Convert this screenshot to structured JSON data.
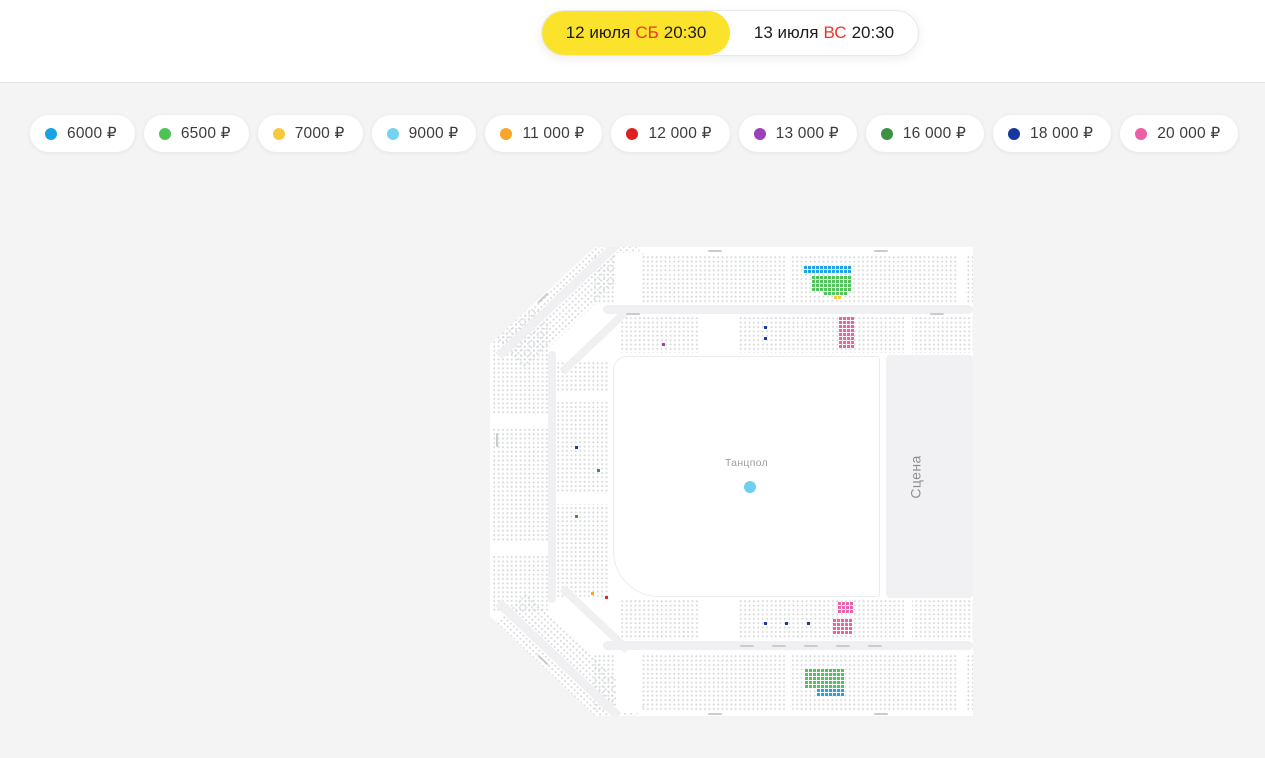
{
  "header": {
    "tabs": [
      {
        "date": "12 июля",
        "day": "СБ",
        "time": "20:30",
        "active": true
      },
      {
        "date": "13 июля",
        "day": "ВС",
        "time": "20:30",
        "active": false
      }
    ],
    "active_tab_color": "#fbe22b",
    "day_accent_color": "#ee342b"
  },
  "legend": {
    "items": [
      {
        "label": "6000 ₽",
        "color": "#1ba2e4"
      },
      {
        "label": "6500 ₽",
        "color": "#4ec257"
      },
      {
        "label": "7000 ₽",
        "color": "#f6ca3e"
      },
      {
        "label": "9000 ₽",
        "color": "#74d3f2"
      },
      {
        "label": "11 000 ₽",
        "color": "#f8a62a"
      },
      {
        "label": "12 000 ₽",
        "color": "#dd1f1f"
      },
      {
        "label": "13 000 ₽",
        "color": "#9c3fba"
      },
      {
        "label": "16 000 ₽",
        "color": "#3c9145"
      },
      {
        "label": "18 000 ₽",
        "color": "#16379c"
      },
      {
        "label": "20 000 ₽",
        "color": "#ea5fa6"
      }
    ]
  },
  "map": {
    "dancefloor_label": "Танцпол",
    "stage_label": "Сцена",
    "dancefloor_dot_color": "#6ed0f1",
    "seat_clusters": [
      {
        "color": "#1ba2e4",
        "x": 314,
        "y": 21,
        "rows": 2,
        "cols": 12
      },
      {
        "color": "#4ec257",
        "x": 322,
        "y": 31,
        "rows": 4,
        "cols": 10
      },
      {
        "color": "#4ec257",
        "x": 334,
        "y": 47,
        "rows": 1,
        "cols": 6
      },
      {
        "color": "#f6ca3e",
        "x": 344,
        "y": 51,
        "rows": 1,
        "cols": 2
      },
      {
        "color": "#ea5fa6",
        "x": 349,
        "y": 72,
        "rows": 8,
        "cols": 4
      },
      {
        "color": "#16379c",
        "x": 274,
        "y": 81,
        "rows": 1,
        "cols": 1
      },
      {
        "color": "#16379c",
        "x": 274,
        "y": 92,
        "rows": 1,
        "cols": 1
      },
      {
        "color": "#9c3fba",
        "x": 172,
        "y": 98,
        "rows": 1,
        "cols": 1
      },
      {
        "color": "#16379c",
        "x": 85,
        "y": 201,
        "rows": 1,
        "cols": 1
      },
      {
        "color": "#3c9145",
        "x": 107,
        "y": 224,
        "rows": 1,
        "cols": 1
      },
      {
        "color": "#3c9145",
        "x": 85,
        "y": 270,
        "rows": 1,
        "cols": 1
      },
      {
        "color": "#f8a62a",
        "x": 101,
        "y": 347,
        "rows": 1,
        "cols": 1
      },
      {
        "color": "#dd1f1f",
        "x": 115,
        "y": 351,
        "rows": 1,
        "cols": 1
      },
      {
        "color": "#ea5fa6",
        "x": 348,
        "y": 357,
        "rows": 3,
        "cols": 4
      },
      {
        "color": "#ea5fa6",
        "x": 343,
        "y": 374,
        "rows": 4,
        "cols": 5
      },
      {
        "color": "#16379c",
        "x": 274,
        "y": 377,
        "rows": 1,
        "cols": 1
      },
      {
        "color": "#16379c",
        "x": 295,
        "y": 377,
        "rows": 1,
        "cols": 1
      },
      {
        "color": "#16379c",
        "x": 317,
        "y": 377,
        "rows": 1,
        "cols": 1
      },
      {
        "color": "#4ec257",
        "x": 315,
        "y": 424,
        "rows": 5,
        "cols": 10
      },
      {
        "color": "#1ba2e4",
        "x": 327,
        "y": 444,
        "rows": 2,
        "cols": 7
      }
    ]
  }
}
